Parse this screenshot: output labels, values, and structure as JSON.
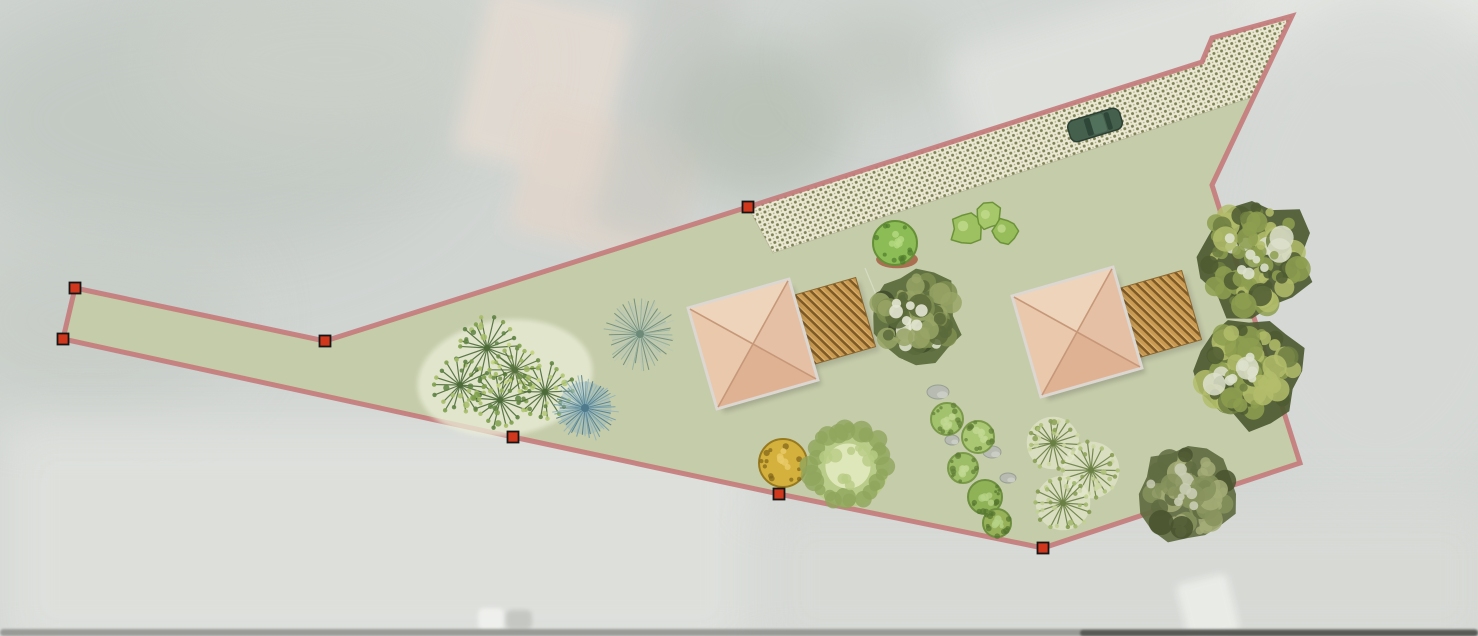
{
  "canvas": {
    "width": 1478,
    "height": 636,
    "base_color": "#d1d5d2"
  },
  "plan": {
    "boundary": {
      "stroke_color": "#c47c7c",
      "stroke_width": 5,
      "stroke_opacity": 0.92,
      "path": [
        [
          75,
          288
        ],
        [
          325,
          341
        ],
        [
          748,
          207
        ],
        [
          1202,
          62
        ],
        [
          1212,
          38
        ],
        [
          1292,
          16
        ],
        [
          1212,
          185
        ],
        [
          1300,
          463
        ],
        [
          1043,
          548
        ],
        [
          779,
          494
        ],
        [
          513,
          437
        ],
        [
          63,
          339
        ]
      ]
    },
    "lawn": {
      "fill": "#c4cba8",
      "opacity": 0.97
    },
    "vertex_handles": {
      "fill": "#d0371c",
      "stroke": "#161616",
      "size": 11,
      "points": [
        [
          75,
          288
        ],
        [
          63,
          339
        ],
        [
          325,
          341
        ],
        [
          513,
          437
        ],
        [
          748,
          207
        ],
        [
          779,
          494
        ],
        [
          1043,
          548
        ]
      ]
    },
    "driveway": {
      "polygon": [
        [
          748,
          207
        ],
        [
          1202,
          62
        ],
        [
          1212,
          38
        ],
        [
          1292,
          16
        ],
        [
          1253,
          97
        ],
        [
          773,
          253
        ]
      ],
      "base_color": "#ebe8d3",
      "dot_color": "#7e8355",
      "dot_color_light": "#a9ab7e",
      "edge_color": "#a8a98c",
      "pattern_angle": -18
    },
    "buildings": [
      {
        "cx": 753,
        "cy": 344,
        "half": 51,
        "rotation": -16
      },
      {
        "cx": 1077,
        "cy": 332,
        "half": 51,
        "rotation": -16
      }
    ],
    "building_style": {
      "facet_top": "#eed4ba",
      "facet_right": "#e5c0a4",
      "facet_bottom": "#e0b294",
      "facet_left": "#e9c8ac",
      "ridge": "#c69879",
      "edging": "#dcd7d0",
      "shadow": "#3a3a34"
    },
    "decks": [
      {
        "cx": 831,
        "cy": 322,
        "half": 36,
        "rotation": -16
      },
      {
        "cx": 1157,
        "cy": 315,
        "half": 36,
        "rotation": -16
      }
    ],
    "deck_style": {
      "base": "#c99b52",
      "stripe": "#7e5a27",
      "stripe_light": "#e2b671",
      "edge": "#8a6630"
    },
    "car": {
      "cx": 1095,
      "cy": 125,
      "length": 54,
      "width": 22,
      "rotation": -17,
      "body": "#45604c",
      "trim": "#2c4034",
      "glass": "#2e4638",
      "roof": "#52715d"
    },
    "trees": [
      {
        "type": "bgblob",
        "x": 505,
        "y": 378,
        "rx": 88,
        "ry": 58,
        "rot": -8,
        "fill": "#eaeed8",
        "opacity": 0.75
      },
      {
        "type": "fan",
        "x": 487,
        "y": 348,
        "r": 30,
        "palette": [
          "#7fa04e",
          "#a6bd68",
          "#5e8242"
        ],
        "line": "#4c6a38",
        "bg": ""
      },
      {
        "type": "fan",
        "x": 460,
        "y": 385,
        "r": 27,
        "palette": [
          "#7fa04e",
          "#a6bd68",
          "#5e8242"
        ],
        "line": "#4c6a38",
        "bg": ""
      },
      {
        "type": "fan",
        "x": 500,
        "y": 400,
        "r": 28,
        "palette": [
          "#7fa04e",
          "#a6bd68",
          "#5e8242"
        ],
        "line": "#4c6a38",
        "bg": ""
      },
      {
        "type": "fan",
        "x": 545,
        "y": 392,
        "r": 27,
        "palette": [
          "#8aa852",
          "#b2c873",
          "#63853f"
        ],
        "line": "#4c6a38",
        "bg": ""
      },
      {
        "type": "fan",
        "x": 515,
        "y": 370,
        "r": 24,
        "palette": [
          "#9ab45c",
          "#c3d47f",
          "#6d8c46"
        ],
        "line": "#55703c",
        "bg": ""
      },
      {
        "type": "spiky",
        "x": 585,
        "y": 408,
        "r": 33,
        "colors": [
          "#6f9aa8",
          "#8fb3bd",
          "#4e7a8c"
        ]
      },
      {
        "type": "spiky",
        "x": 640,
        "y": 334,
        "r": 36,
        "colors": [
          "#93af9e",
          "#b9c6b4",
          "#6d8a78"
        ]
      },
      {
        "type": "round",
        "x": 895,
        "y": 243,
        "r": 22,
        "fill": "#8cbc55",
        "edge": "#659038",
        "spots": "#b7d983",
        "dark": "#4f7a2c",
        "base": "#a3573b"
      },
      {
        "type": "blob",
        "x": 966,
        "y": 229,
        "r": 15,
        "fill": "#9dc161",
        "edge": "#6d9339"
      },
      {
        "type": "blob",
        "x": 988,
        "y": 217,
        "r": 13,
        "fill": "#a6c86a",
        "edge": "#6d9339"
      },
      {
        "type": "blob",
        "x": 1004,
        "y": 231,
        "r": 12,
        "fill": "#96bd5a",
        "edge": "#6d9339"
      },
      {
        "type": "bigtex",
        "x": 916,
        "y": 316,
        "r": 47,
        "palette": [
          "#7e8d50",
          "#98a566",
          "#5a6a3a",
          "#e3e6d3",
          "#3e4a2c"
        ]
      },
      {
        "type": "rock",
        "x": 938,
        "y": 392,
        "rx": 11,
        "ry": 7
      },
      {
        "type": "rock",
        "x": 952,
        "y": 440,
        "rx": 7,
        "ry": 5
      },
      {
        "type": "rock",
        "x": 992,
        "y": 452,
        "rx": 9,
        "ry": 6
      },
      {
        "type": "rock",
        "x": 1008,
        "y": 478,
        "rx": 8,
        "ry": 5
      },
      {
        "type": "round",
        "x": 947,
        "y": 419,
        "r": 16,
        "fill": "#a3c26d",
        "edge": "#7a9a49",
        "spots": "#c2d894",
        "dark": "#5f7e36",
        "base": ""
      },
      {
        "type": "round",
        "x": 978,
        "y": 437,
        "r": 16,
        "fill": "#aac873",
        "edge": "#7a9a49",
        "spots": "#c2d894",
        "dark": "#5f7e36",
        "base": ""
      },
      {
        "type": "round",
        "x": 963,
        "y": 468,
        "r": 15,
        "fill": "#9dbd66",
        "edge": "#7a9a49",
        "spots": "#c2d894",
        "dark": "#5f7e36",
        "base": ""
      },
      {
        "type": "round",
        "x": 985,
        "y": 497,
        "r": 17,
        "fill": "#8fb257",
        "edge": "#6d8f3f",
        "spots": "#b5d286",
        "dark": "#54752f",
        "base": ""
      },
      {
        "type": "round",
        "x": 997,
        "y": 523,
        "r": 14,
        "fill": "#97b159",
        "edge": "#6d8f3f",
        "spots": "#b5d286",
        "dark": "#54752f",
        "base": ""
      },
      {
        "type": "round",
        "x": 783,
        "y": 463,
        "r": 24,
        "fill": "#d4b03c",
        "edge": "#97791f",
        "spots": "#e8cc6a",
        "dark": "#7e6418",
        "base": ""
      },
      {
        "type": "fuzzy",
        "x": 848,
        "y": 466,
        "r": 41,
        "inner": "#e2eabf",
        "mid": "#b8cc85",
        "edgec": "#90a55c"
      },
      {
        "type": "fan",
        "x": 1053,
        "y": 443,
        "r": 25,
        "palette": [
          "#aec178",
          "#8aa055",
          "#cdd8a2"
        ],
        "line": "#6a7f44",
        "bg": "#e6ead0"
      },
      {
        "type": "fan",
        "x": 1091,
        "y": 470,
        "r": 27,
        "palette": [
          "#aec178",
          "#8aa055",
          "#cdd8a2"
        ],
        "line": "#6a7f44",
        "bg": "#e6ead0"
      },
      {
        "type": "fan",
        "x": 1063,
        "y": 503,
        "r": 26,
        "palette": [
          "#a2b86c",
          "#849a50",
          "#c2d094"
        ],
        "line": "#6a7f44",
        "bg": "#e6ead0"
      },
      {
        "type": "bigtex",
        "x": 1188,
        "y": 494,
        "r": 48,
        "palette": [
          "#87935d",
          "#a5ad77",
          "#5f6b41",
          "#c9cdb4",
          "#49532f"
        ]
      },
      {
        "type": "bigtex",
        "x": 1252,
        "y": 257,
        "r": 61,
        "palette": [
          "#8e9f50",
          "#b3bd6b",
          "#4d5a31",
          "#dde1cc",
          "#6f7f42"
        ]
      },
      {
        "type": "bigtex",
        "x": 1249,
        "y": 371,
        "r": 55,
        "palette": [
          "#8e9f50",
          "#b3bd6b",
          "#4d5a31",
          "#dde1cc",
          "#6f7f42"
        ]
      }
    ],
    "misc_lines": [
      {
        "x1": 865,
        "y1": 268,
        "x2": 903,
        "y2": 360,
        "color": "#ffffff",
        "opacity": 0.3,
        "width": 1.2
      }
    ]
  },
  "background_features": [
    {
      "kind": "blob",
      "x": 200,
      "y": 120,
      "rx": 260,
      "ry": 140,
      "color": "#c2c9c3",
      "blur": 40,
      "opacity": 0.9,
      "rot": 0
    },
    {
      "kind": "blob",
      "x": 90,
      "y": 320,
      "rx": 150,
      "ry": 90,
      "color": "#c6ccc6",
      "blur": 35,
      "opacity": 0.8,
      "rot": 0
    },
    {
      "kind": "blob",
      "x": 330,
      "y": 60,
      "rx": 180,
      "ry": 90,
      "color": "#ccd1c9",
      "blur": 35,
      "opacity": 0.8,
      "rot": 0
    },
    {
      "kind": "rect",
      "x": 470,
      "y": 0,
      "w": 150,
      "h": 170,
      "color": "#e4dbd2",
      "blur": 10,
      "opacity": 0.85,
      "rot": 14
    },
    {
      "kind": "rect",
      "x": 520,
      "y": 120,
      "w": 170,
      "h": 130,
      "color": "#e2d6cb",
      "blur": 10,
      "opacity": 0.8,
      "rot": 14
    },
    {
      "kind": "rect",
      "x": 620,
      "y": -20,
      "w": 90,
      "h": 260,
      "color": "#c6c9c4",
      "blur": 14,
      "opacity": 0.7,
      "rot": 14
    },
    {
      "kind": "blob",
      "x": 760,
      "y": 120,
      "rx": 90,
      "ry": 80,
      "color": "#b6bfb4",
      "blur": 25,
      "opacity": 0.8,
      "rot": 0
    },
    {
      "kind": "blob",
      "x": 880,
      "y": 60,
      "rx": 70,
      "ry": 50,
      "color": "#c0c7bd",
      "blur": 25,
      "opacity": 0.7,
      "rot": 0
    },
    {
      "kind": "rect",
      "x": 950,
      "y": -30,
      "w": 560,
      "h": 130,
      "color": "#e0e2de",
      "blur": 18,
      "opacity": 0.9,
      "rot": -17
    },
    {
      "kind": "blob",
      "x": 1400,
      "y": 10,
      "rx": 150,
      "ry": 60,
      "color": "#e8eae6",
      "blur": 20,
      "opacity": 0.8,
      "rot": 0
    },
    {
      "kind": "blob",
      "x": 1380,
      "y": 250,
      "rx": 180,
      "ry": 260,
      "color": "#d6d9d6",
      "blur": 30,
      "opacity": 0.9,
      "rot": 0
    },
    {
      "kind": "rect",
      "x": 0,
      "y": 420,
      "w": 760,
      "h": 240,
      "color": "#dfe1dd",
      "blur": 25,
      "opacity": 0.9,
      "rot": 0
    },
    {
      "kind": "rect",
      "x": 760,
      "y": 500,
      "w": 740,
      "h": 160,
      "color": "#d8dad6",
      "blur": 25,
      "opacity": 0.9,
      "rot": 0
    },
    {
      "kind": "rect",
      "x": 478,
      "y": 608,
      "w": 26,
      "h": 22,
      "color": "#f1f2ef",
      "blur": 2,
      "opacity": 0.9,
      "rot": 0
    },
    {
      "kind": "rect",
      "x": 506,
      "y": 610,
      "w": 26,
      "h": 20,
      "color": "#c3c5c1",
      "blur": 2,
      "opacity": 0.9,
      "rot": 0
    },
    {
      "kind": "rect",
      "x": 1182,
      "y": 578,
      "w": 52,
      "h": 60,
      "color": "#edefeb",
      "blur": 4,
      "opacity": 0.85,
      "rot": -14
    },
    {
      "kind": "rect",
      "x": 0,
      "y": 629,
      "w": 1478,
      "h": 7,
      "color": "#8e908c",
      "blur": 1,
      "opacity": 0.85,
      "rot": 0
    },
    {
      "kind": "rect",
      "x": 1080,
      "y": 630,
      "w": 398,
      "h": 6,
      "color": "#4c4e4a",
      "blur": 1,
      "opacity": 0.85,
      "rot": 0
    }
  ]
}
